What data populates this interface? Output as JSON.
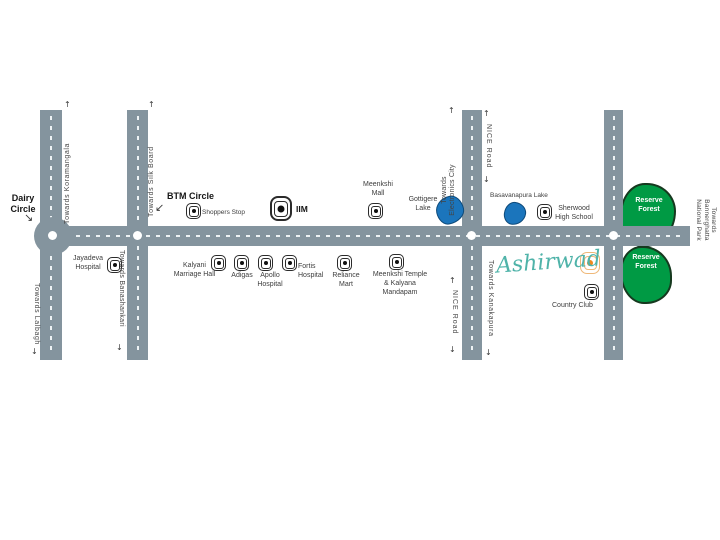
{
  "junction_labels": {
    "dairy_circle": "Dairy Circle",
    "btm_circle": "BTM Circle"
  },
  "road_labels": {
    "koramangala": "Towards Koramangala",
    "silk_board": "Towards Silk Board",
    "lalbagh": "Towards Lalbagh",
    "banashankari": "Towards Banashankari",
    "electronics_city": "Towards Electronics City",
    "nice_road": "NICE Road",
    "kanakapura": "Towards Kanakapura",
    "bannerghatta": "Towards Bannerghatta National Park"
  },
  "landmarks": {
    "shoppers_stop": "Shoppers Stop",
    "iim": "IIM",
    "meenkshi_mall": "Meenkshi Mall",
    "jayadeva_hospital": "Jayadeva Hospital",
    "kalyani_marriage_hall": "Kalyani Marriage Hall",
    "adigas": "Adigas",
    "apollo_hospital": "Apollo Hospital",
    "fortis_hospital": "Fortis Hospital",
    "reliance_mart": "Reliance Mart",
    "meenkshi_temple": "Meenkshi Temple & Kalyana Mandapam",
    "sherwood_high_school": "Sherwood High School",
    "country_club": "Country Club"
  },
  "lakes": {
    "gottigere": "Gottigere Lake",
    "basavanapura": "Basavanapura Lake"
  },
  "forest": {
    "label": "Reserve Forest"
  },
  "logo": {
    "name": "Ashirwad"
  },
  "icons": {
    "up_arrow": "↑",
    "down_arrow": "↓",
    "sw_arrow": "↙",
    "se_arrow": "↘"
  },
  "colors": {
    "road": "#84949e",
    "lake_blue": "#1b75bc",
    "forest_green": "#009a44",
    "logo_teal": "#4fb3a9",
    "marker_orange": "#ee8a1e",
    "text": "#3d3d3d"
  }
}
